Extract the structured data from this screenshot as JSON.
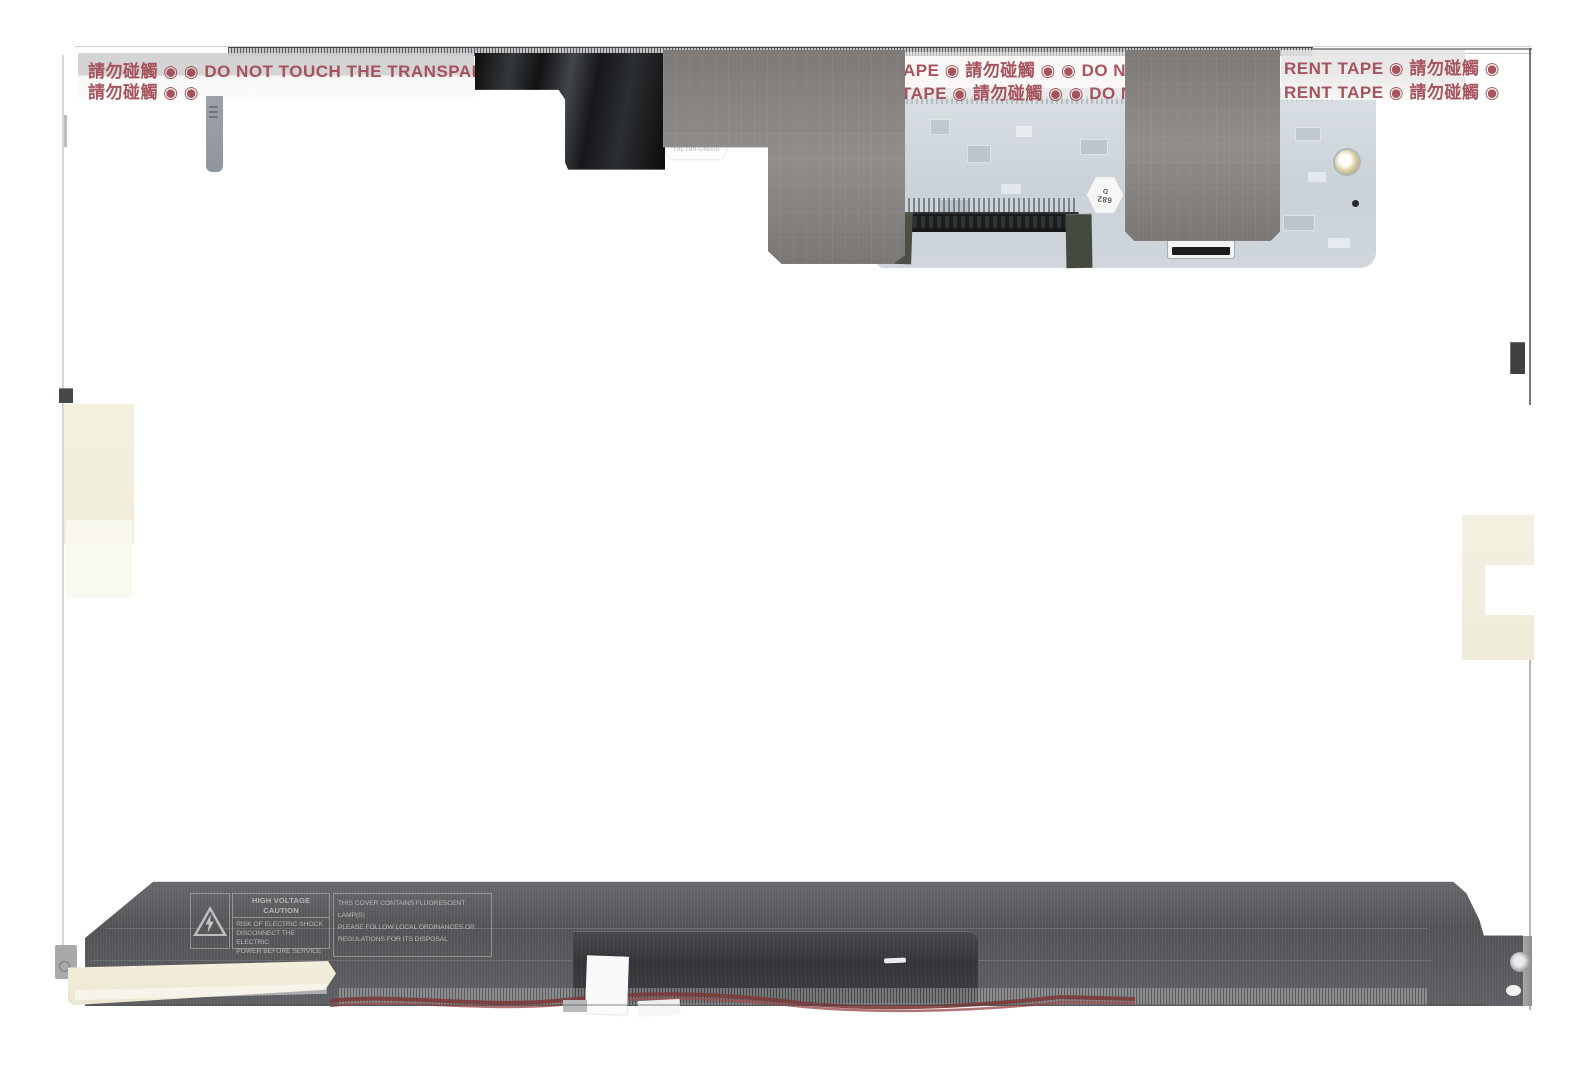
{
  "warning_tape": {
    "row1_left": "請勿碰觸 ◉   ◉ DO NOT TOUCH THE TRANSPARENT T",
    "row2_left": "請勿碰觸 ◉   ◉",
    "row1_mid": "APE ◉ 請勿碰觸 ◉   ◉ DO N",
    "row2_mid": "TAPE ◉ 請勿碰觸 ◉   ◉ DO N",
    "row1_right": "RENT TAPE ◉ 請勿碰觸 ◉",
    "row2_right": "RENT TAPE ◉ 請勿碰觸 ◉",
    "text_color": "#a34c55"
  },
  "caution_label": {
    "title_line1": "HIGH VOLTAGE",
    "title_line2": "CAUTION",
    "body_line1": "RISK OF ELECTRIC SHOCK",
    "body_line2": "DISCONNECT THE ELECTRIC",
    "body_line3": "POWER BEFORE SERVICE"
  },
  "disposal_label": {
    "line1": "THIS COVER CONTAINS FLUORESCENT LAMP(S)",
    "line2": "PLEASE FOLLOW LOCAL ORDINANCES OR",
    "line3": "REGULATIONS FOR ITS DISPOSAL"
  },
  "stickers": {
    "hex_line1": "682",
    "hex_line2": "D",
    "serial_label": "Y8C7B9-GN000"
  },
  "icons": {
    "no_touch_symbol": "◉",
    "high_voltage_icon": "triangle-lightning"
  },
  "colors": {
    "tape_red_text": "#a34c55",
    "fabric_tape": "#8b8784",
    "foil_tape": "#1d1f22",
    "pcb_board": "#c3ccd3",
    "metal_cover": "#5b5c5e",
    "inverter_cover": "#3b3d40",
    "cream_tape": "#f2eedb",
    "wire_red": "#7c3a3a"
  }
}
